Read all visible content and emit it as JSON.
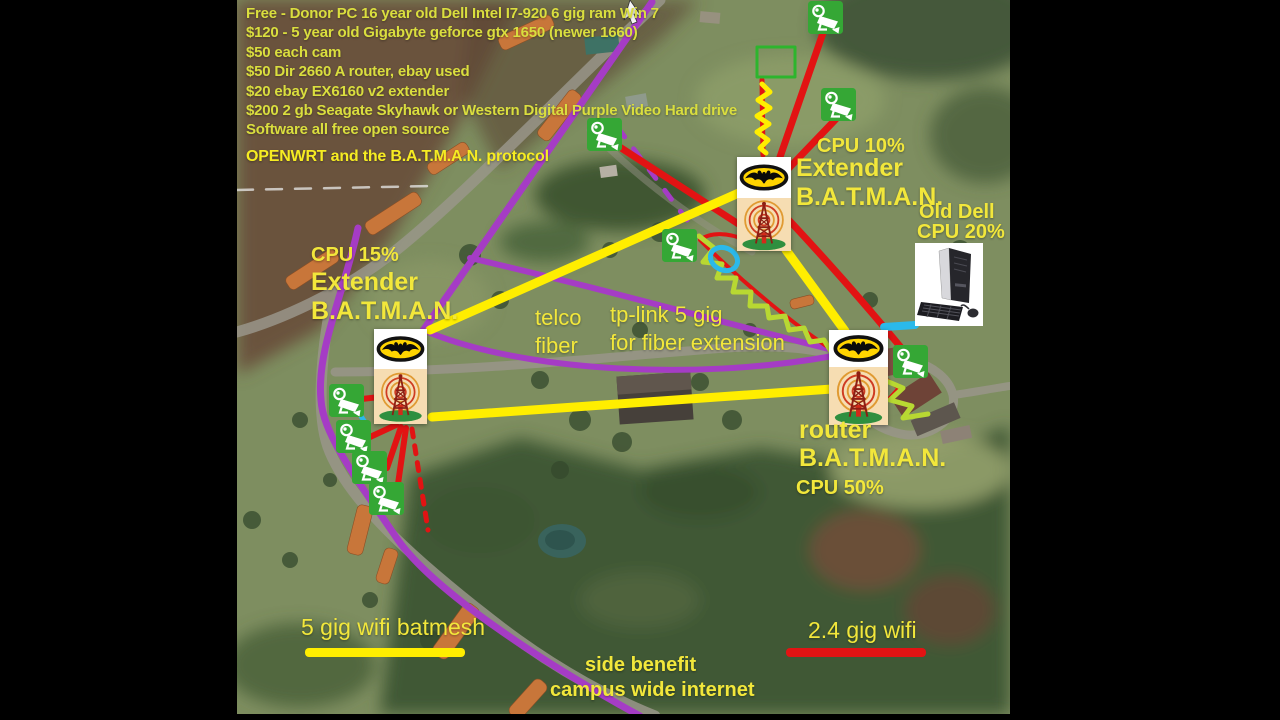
{
  "cost_list": {
    "lines": [
      "Free - Donor PC 16 year old Dell Intel I7-920 6 gig ram Win 7",
      "$120 - 5 year old Gigabyte geforce gtx 1650 (newer 1660)",
      "$50 each cam",
      "$50 Dir 2660 A router, ebay used",
      "$20 ebay EX6160 v2 extender",
      "$200 2 gb Seagate Skyhawk or Western Digital Purple Video Hard drive",
      "Software all free open source"
    ],
    "protocol_line": "OPENWRT and the B.A.T.M.A.N. protocol"
  },
  "labels": {
    "top_extender": {
      "cpu": "CPU 10%",
      "name": "Extender",
      "protocol": "B.A.T.M.A.N."
    },
    "left_extender": {
      "cpu": "CPU 15%",
      "name": "Extender",
      "protocol": "B.A.T.M.A.N."
    },
    "right_router": {
      "name": "router",
      "protocol": "B.A.T.M.A.N.",
      "cpu": "CPU 50%"
    },
    "old_dell": {
      "title": "Old Dell",
      "cpu": "CPU 20%"
    },
    "telco_fiber": {
      "line1": "telco",
      "line2": "fiber"
    },
    "tplink": {
      "line1": "tp-link 5 gig",
      "line2": "for fiber extension"
    },
    "side_benefit": {
      "line1": "side benefit",
      "line2": "campus wide internet"
    }
  },
  "legend": {
    "wifi_5g": "5 gig wifi batmesh",
    "wifi_24g": "2.4 gig wifi"
  },
  "colors": {
    "fiber_purple": "#a53cc5",
    "wifi_5g_yellow": "#ffee00",
    "wifi_24g_red": "#e21313",
    "camera_green": "#35a735",
    "label_yellow": "#f2e73b",
    "cost_text_yellow": "#dade3e",
    "cyan_accent": "#2bb9ea",
    "zigzag_green": "#b8d832"
  },
  "icons": {
    "descriptions": {
      "camera": "security-camera-icon",
      "tower": "radio-tower-icon",
      "batman": "batman-logo-icon",
      "pc": "desktop-pc-icon"
    },
    "cameras": [
      {
        "x": 808,
        "y": 1
      },
      {
        "x": 821,
        "y": 88
      },
      {
        "x": 587,
        "y": 118
      },
      {
        "x": 662,
        "y": 229
      },
      {
        "x": 893,
        "y": 345
      },
      {
        "x": 329,
        "y": 384
      },
      {
        "x": 336,
        "y": 420
      },
      {
        "x": 352,
        "y": 451
      },
      {
        "x": 369,
        "y": 482
      }
    ],
    "towers": [
      {
        "x": 737,
        "y": 157,
        "w": 54,
        "batman_h": 41,
        "tower_h": 53
      },
      {
        "x": 374,
        "y": 329,
        "w": 53,
        "batman_h": 40,
        "tower_h": 55
      },
      {
        "x": 829,
        "y": 330,
        "w": 59,
        "batman_h": 37,
        "tower_h": 58
      }
    ],
    "pc": {
      "x": 915,
      "y": 243,
      "w": 68,
      "h": 83
    }
  }
}
